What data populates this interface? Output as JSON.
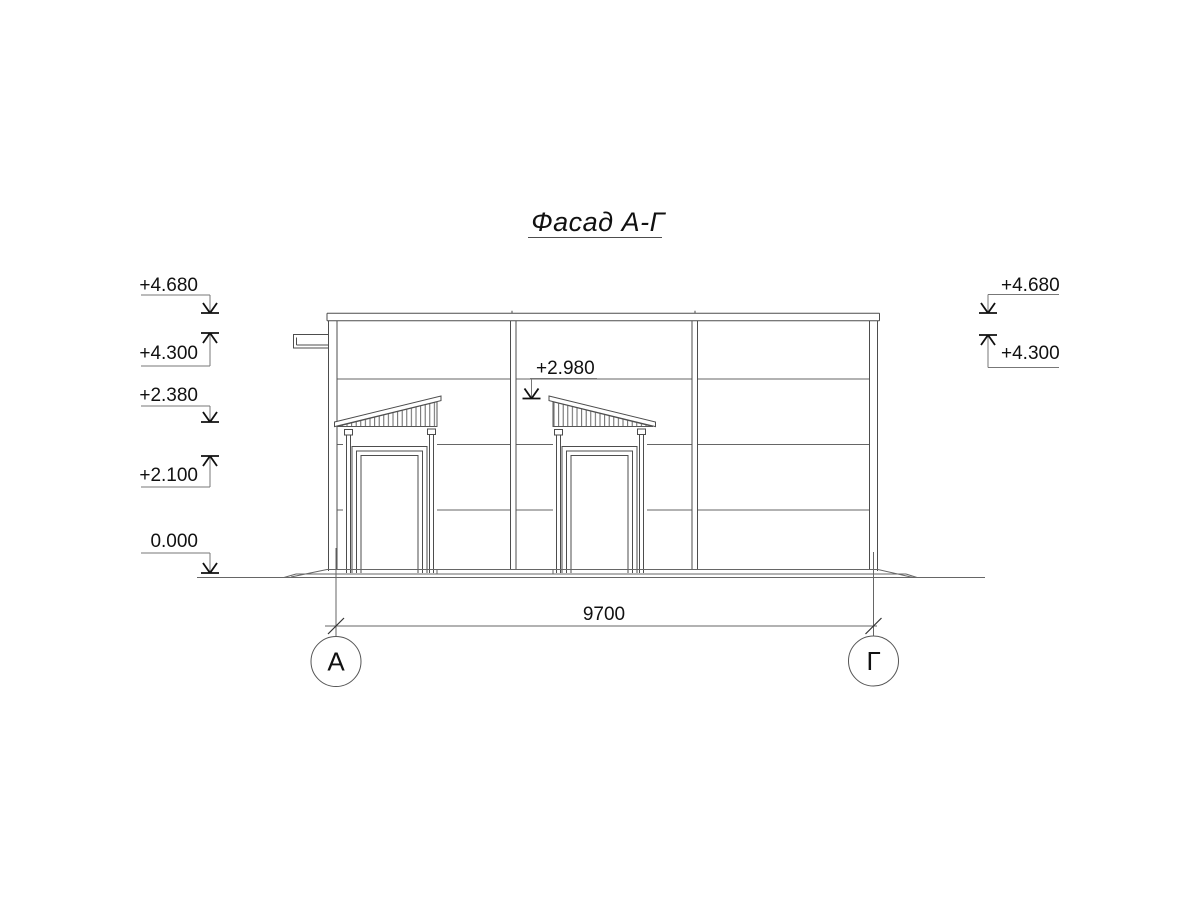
{
  "title": "Фасад А-Г",
  "elevation_marks": {
    "left": [
      {
        "label": "+4.680",
        "direction": "down"
      },
      {
        "label": "+4.300",
        "direction": "up"
      },
      {
        "label": "+2.380",
        "direction": "down"
      },
      {
        "label": "+2.100",
        "direction": "up"
      },
      {
        "label": "0.000",
        "direction": "down"
      }
    ],
    "right": [
      {
        "label": "+4.680",
        "direction": "down"
      },
      {
        "label": "+4.300",
        "direction": "up"
      }
    ],
    "canopy": {
      "label": "+2.980",
      "direction": "down"
    }
  },
  "dimension": {
    "total_width": "9700"
  },
  "axes": {
    "left": "А",
    "right": "Г"
  },
  "colors": {
    "line": "#4d4d4d",
    "text": "#111111",
    "background": "#ffffff"
  }
}
